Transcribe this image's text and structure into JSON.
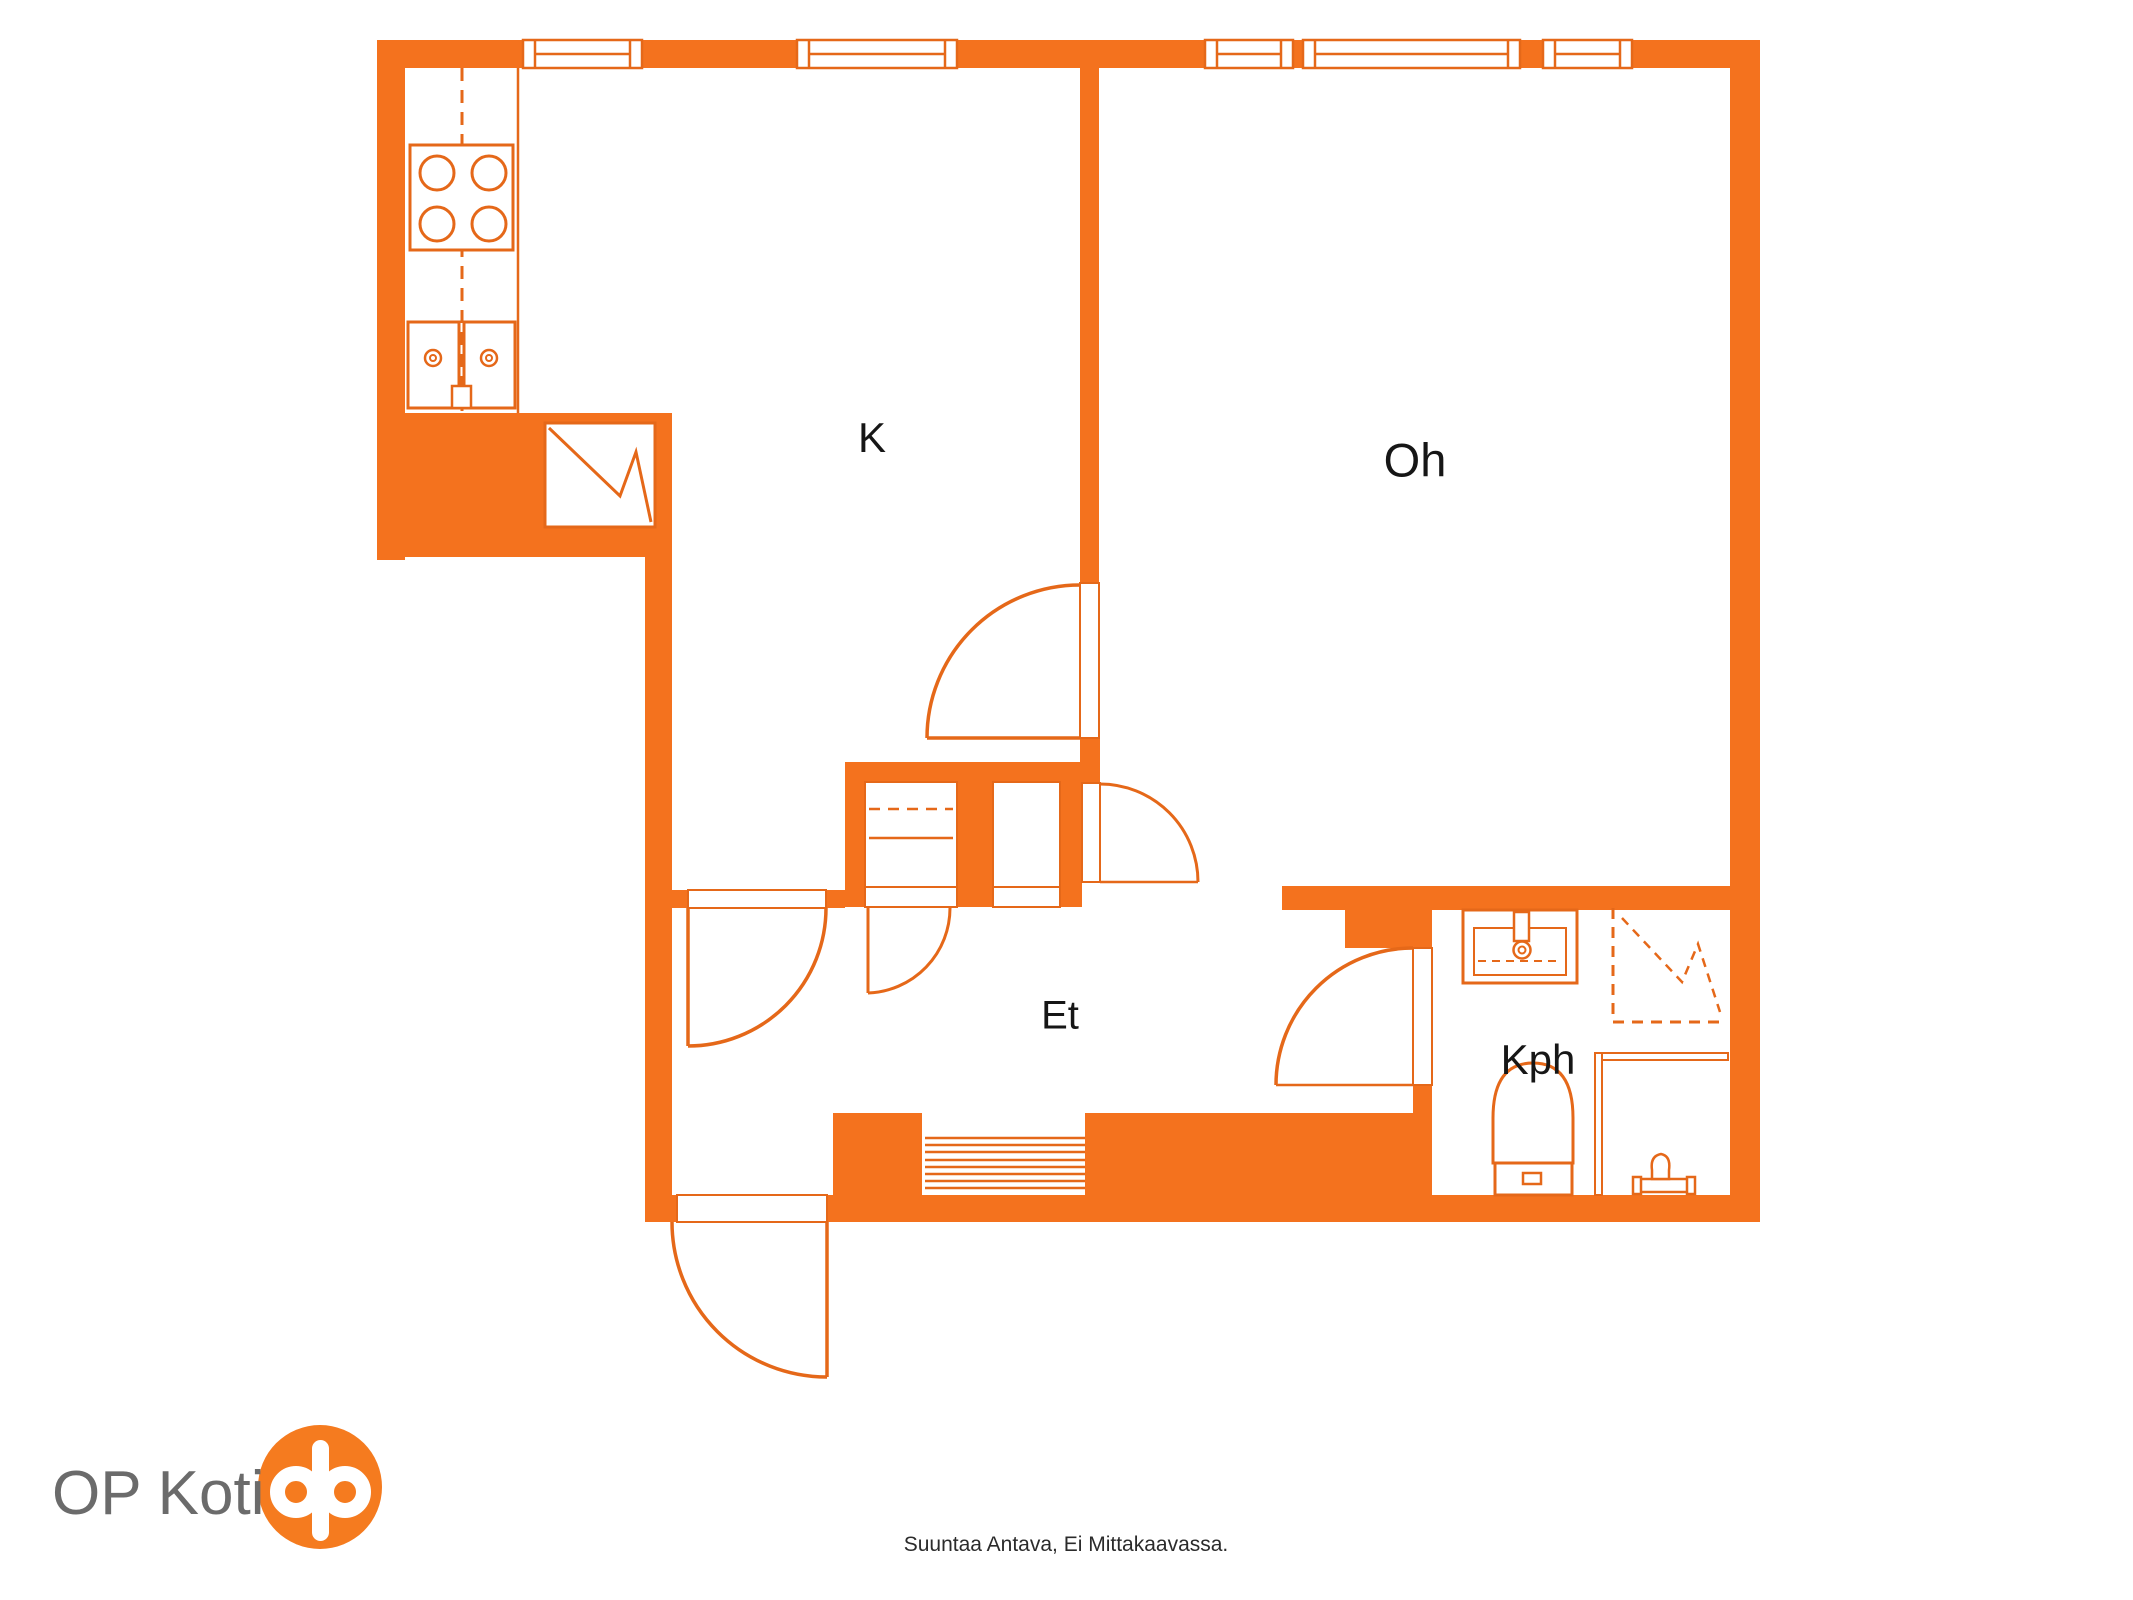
{
  "plan": {
    "rooms": [
      {
        "id": "kitchen",
        "label": "K"
      },
      {
        "id": "living-room",
        "label": "Oh"
      },
      {
        "id": "hallway",
        "label": "Et"
      },
      {
        "id": "bathroom",
        "label": "Kph"
      }
    ],
    "window_count": 5,
    "fixtures": {
      "kitchen": [
        "stove",
        "sink",
        "refrigerator"
      ],
      "bathroom": [
        "washbasin",
        "shower",
        "toilet",
        "floor-drain",
        "glass-partition"
      ],
      "hallway": [
        "wardrobe",
        "stairs",
        "entry-door"
      ]
    }
  },
  "branding": {
    "company": "OP Koti",
    "logo_icon": "op-logo-icon"
  },
  "footer": {
    "disclaimer": "Suuntaa Antava, Ei Mittakaavassa."
  },
  "colors": {
    "wall": "#F4721E",
    "line": "#E56819",
    "logo": "#F57B1F",
    "room_label": "#161616",
    "brand_text": "#6B6B6B",
    "disclaimer_text": "#2B2B2B",
    "background": "#FFFFFF"
  }
}
